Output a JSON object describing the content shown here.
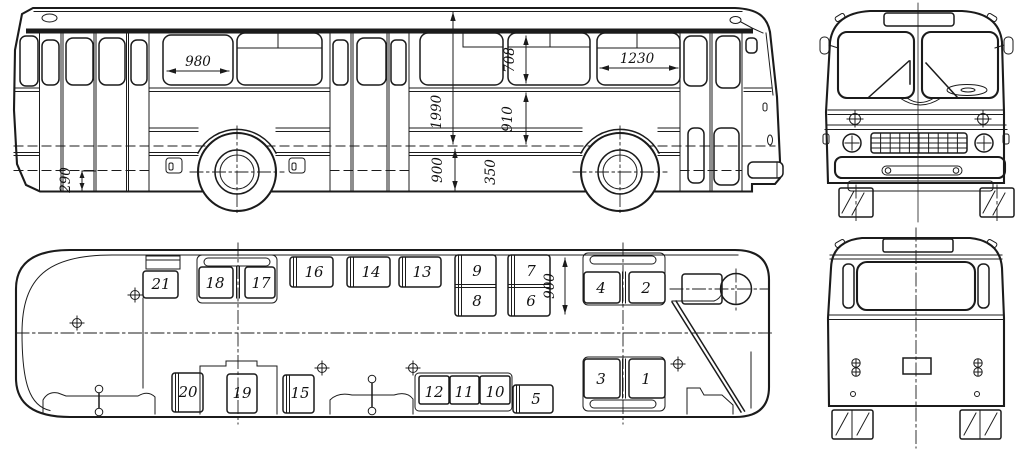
{
  "side_view": {
    "dims": {
      "w980": "980",
      "h708": "708",
      "h1990": "1990",
      "h910": "910",
      "w1230": "1230",
      "h900": "900",
      "h350": "350",
      "h290": "290"
    }
  },
  "plan_view": {
    "dims": {
      "d900": "900"
    },
    "seats": [
      "1",
      "2",
      "3",
      "4",
      "5",
      "6",
      "7",
      "8",
      "9",
      "10",
      "11",
      "12",
      "13",
      "14",
      "15",
      "16",
      "17",
      "18",
      "19",
      "20",
      "21"
    ]
  }
}
